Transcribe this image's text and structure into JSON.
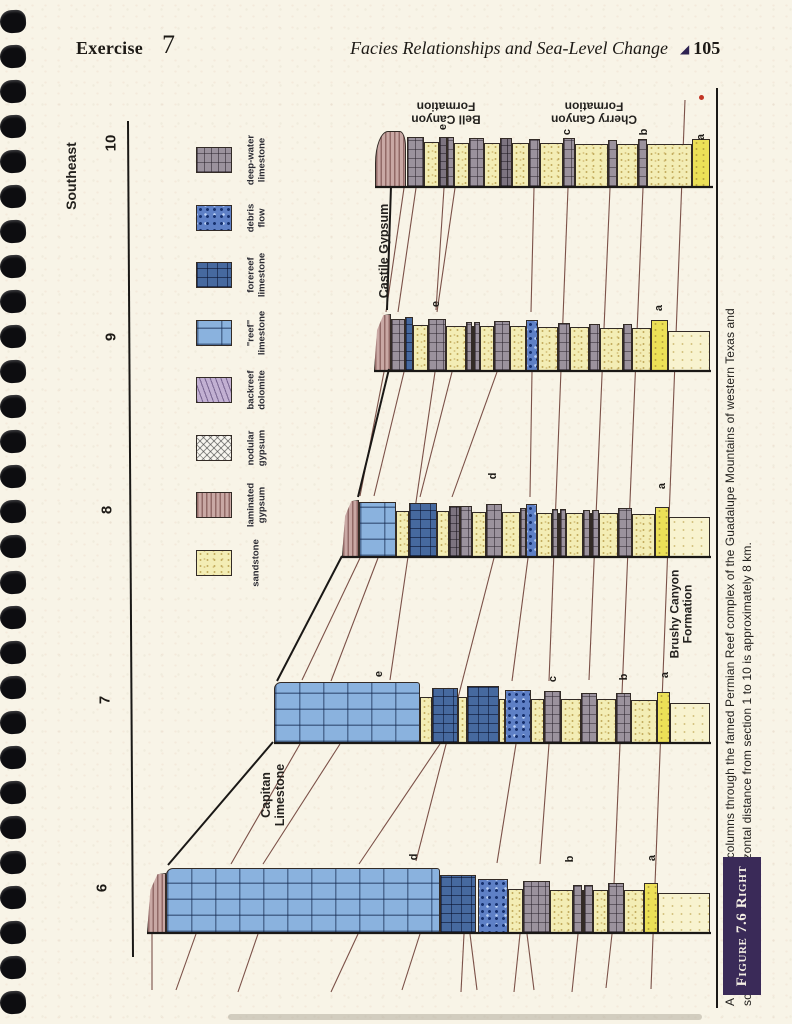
{
  "page": {
    "header": {
      "exercise_label": "Exercise",
      "exercise_number": "7",
      "running_title": "Facies Relationships and Sea-Level Change",
      "page_marker": "◢",
      "page_number": "105"
    }
  },
  "figure": {
    "colors": {
      "black_line": "#1a1816",
      "thin_line": "#7b5148",
      "figure_label_bg": "#3a2a58",
      "reef_blue": "#8ab2de",
      "forereef_blue": "#46699f",
      "debris_blue": "#5e80c6",
      "sandstone_yellow": "#f3edb5",
      "laminated_gypsum_pink": "#c9a8a4",
      "deepwater_gray": "#9b929d"
    },
    "direction_label": "Southeast",
    "section_numbers": [
      [
        "10",
        112,
        143
      ],
      [
        "9",
        112,
        337
      ],
      [
        "8",
        108,
        510
      ],
      [
        "7",
        106,
        700
      ],
      [
        "6",
        103,
        888
      ]
    ],
    "unit_labels": [
      {
        "text": "Southeast",
        "x": 72,
        "y": 176,
        "rot": -90,
        "size": 14
      },
      {
        "text": "Castile Gypsum",
        "x": 384,
        "y": 251,
        "rot": -90,
        "size": 12.5
      },
      {
        "text": "Capitan\nLimestone",
        "x": 273,
        "y": 795,
        "rot": -90,
        "size": 12.5
      },
      {
        "text": "Brushy Canyon\nFormation",
        "x": 682,
        "y": 614,
        "rot": -90,
        "size": 12
      },
      {
        "text": "Bell Canyon\nFormation",
        "x": 446,
        "y": 112,
        "rot": 180,
        "size": 12
      },
      {
        "text": "Cherry Canyon\nFormation",
        "x": 594,
        "y": 112,
        "rot": 180,
        "size": 12
      }
    ],
    "bed_labels": [
      [
        "e",
        443,
        127
      ],
      [
        "c",
        567,
        132
      ],
      [
        "b",
        644,
        132
      ],
      [
        "a",
        701,
        137
      ],
      [
        "e",
        436,
        304
      ],
      [
        "a",
        659,
        308
      ],
      [
        "d",
        493,
        476
      ],
      [
        "a",
        662,
        486
      ],
      [
        "e",
        379,
        674
      ],
      [
        "c",
        553,
        679
      ],
      [
        "b",
        624,
        677
      ],
      [
        "a",
        665,
        675
      ],
      [
        "d",
        414,
        857
      ],
      [
        "b",
        570,
        859
      ],
      [
        "a",
        652,
        858
      ]
    ],
    "legend": {
      "items": [
        {
          "label": "deep-water\nlimestone",
          "pattern": "gray",
          "y": 160
        },
        {
          "label": "debris\nflow",
          "pattern": "debris",
          "y": 218
        },
        {
          "label": "forereef\nlimestone",
          "pattern": "fore",
          "y": 275
        },
        {
          "label": "\"reef\"\nlimestone",
          "pattern": "reef",
          "y": 333
        },
        {
          "label": "backreef\ndolomite",
          "pattern": "dol",
          "y": 390
        },
        {
          "label": "nodular\ngypsum",
          "pattern": "nod",
          "y": 448
        },
        {
          "label": "laminated\ngypsum",
          "pattern": "lam",
          "y": 505
        },
        {
          "label": "sandstone",
          "pattern": "sand",
          "y": 563
        }
      ]
    },
    "sections": [
      {
        "number": "10",
        "x0": 375,
        "x1": 713,
        "base": 187,
        "blocks": [
          [
            "lam",
            375,
            406,
            56,
            "cap"
          ],
          [
            "gray",
            407,
            424,
            50
          ],
          [
            "sand",
            424,
            439,
            45
          ],
          [
            "grayD",
            439,
            447,
            50
          ],
          [
            "gray",
            447,
            454,
            50
          ],
          [
            "sand",
            454,
            469,
            44
          ],
          [
            "gray",
            469,
            484,
            49
          ],
          [
            "sand",
            484,
            500,
            44
          ],
          [
            "grayD",
            500,
            512,
            49
          ],
          [
            "sand",
            512,
            529,
            44
          ],
          [
            "gray",
            529,
            540,
            48
          ],
          [
            "sand",
            540,
            563,
            44
          ],
          [
            "gray",
            563,
            575,
            49
          ],
          [
            "sand",
            575,
            608,
            43
          ],
          [
            "gray",
            608,
            617,
            47
          ],
          [
            "sand",
            617,
            638,
            43
          ],
          [
            "gray",
            638,
            647,
            48
          ],
          [
            "sand",
            647,
            692,
            43
          ],
          [
            "sandA",
            692,
            710,
            48
          ]
        ]
      },
      {
        "number": "9",
        "x0": 374,
        "x1": 711,
        "base": 371,
        "blocks": [
          [
            "lam",
            374,
            391,
            57,
            "wedge"
          ],
          [
            "gray",
            391,
            405,
            52
          ],
          [
            "fore",
            405,
            413,
            54
          ],
          [
            "sand",
            413,
            428,
            46
          ],
          [
            "gray",
            428,
            446,
            52
          ],
          [
            "sand",
            446,
            466,
            45
          ],
          [
            "gray",
            466,
            472,
            49
          ],
          [
            "sand",
            472,
            474,
            45
          ],
          [
            "gray",
            474,
            480,
            49
          ],
          [
            "sand",
            480,
            494,
            45
          ],
          [
            "gray",
            494,
            510,
            50
          ],
          [
            "sand",
            510,
            526,
            45
          ],
          [
            "debris",
            526,
            538,
            51
          ],
          [
            "sand",
            538,
            558,
            44
          ],
          [
            "gray",
            558,
            570,
            48
          ],
          [
            "sand",
            570,
            589,
            44
          ],
          [
            "gray",
            589,
            600,
            47
          ],
          [
            "sand",
            600,
            623,
            43
          ],
          [
            "gray",
            623,
            632,
            47
          ],
          [
            "sand",
            632,
            651,
            43
          ],
          [
            "sandA",
            651,
            668,
            51
          ],
          [
            "sandP",
            668,
            710,
            40
          ]
        ]
      },
      {
        "number": "8",
        "x0": 342,
        "x1": 711,
        "base": 557,
        "blocks": [
          [
            "lam",
            342,
            359,
            57,
            "wedge"
          ],
          [
            "reef",
            359,
            396,
            55
          ],
          [
            "sand",
            396,
            409,
            46
          ],
          [
            "fore",
            409,
            437,
            54
          ],
          [
            "sand",
            437,
            449,
            46
          ],
          [
            "grayD",
            449,
            460,
            51
          ],
          [
            "gray",
            460,
            472,
            51
          ],
          [
            "sand",
            472,
            486,
            45
          ],
          [
            "gray",
            486,
            502,
            53
          ],
          [
            "sand",
            502,
            520,
            45
          ],
          [
            "gray",
            520,
            526,
            49
          ],
          [
            "debris",
            526,
            537,
            53
          ],
          [
            "sand",
            537,
            552,
            44
          ],
          [
            "gray",
            552,
            558,
            48
          ],
          [
            "sand",
            558,
            560,
            44
          ],
          [
            "gray",
            560,
            566,
            48
          ],
          [
            "sand",
            566,
            583,
            44
          ],
          [
            "gray",
            583,
            590,
            47
          ],
          [
            "sand",
            590,
            592,
            44
          ],
          [
            "gray",
            592,
            599,
            47
          ],
          [
            "sand",
            599,
            618,
            44
          ],
          [
            "gray",
            618,
            632,
            49
          ],
          [
            "sand",
            632,
            655,
            43
          ],
          [
            "sandA",
            655,
            669,
            50
          ],
          [
            "sandP",
            669,
            710,
            40
          ]
        ]
      },
      {
        "number": "7",
        "x0": 274,
        "x1": 711,
        "base": 743,
        "blocks": [
          [
            "reef",
            274,
            420,
            61,
            "reefcap"
          ],
          [
            "sand",
            420,
            432,
            46
          ],
          [
            "fore",
            432,
            458,
            55
          ],
          [
            "sand",
            458,
            467,
            46
          ],
          [
            "fore",
            467,
            499,
            57
          ],
          [
            "sand",
            499,
            505,
            44
          ],
          [
            "debris",
            505,
            531,
            53
          ],
          [
            "sand",
            531,
            544,
            44
          ],
          [
            "gray",
            544,
            561,
            52
          ],
          [
            "sand",
            561,
            581,
            44
          ],
          [
            "gray",
            581,
            597,
            50
          ],
          [
            "sand",
            597,
            616,
            44
          ],
          [
            "gray",
            616,
            631,
            50
          ],
          [
            "sand",
            631,
            657,
            43
          ],
          [
            "sandA",
            657,
            670,
            51
          ],
          [
            "sandP",
            670,
            710,
            40
          ]
        ]
      },
      {
        "number": "6",
        "x0": 147,
        "x1": 711,
        "base": 933,
        "blocks": [
          [
            "lam",
            147,
            166,
            60,
            "wedge"
          ],
          [
            "reef",
            166,
            440,
            65,
            "reefcap"
          ],
          [
            "fore",
            440,
            476,
            58
          ],
          [
            "debris",
            478,
            508,
            54
          ],
          [
            "sand",
            508,
            523,
            44
          ],
          [
            "gray",
            523,
            550,
            52
          ],
          [
            "sand",
            550,
            573,
            43
          ],
          [
            "gray",
            573,
            582,
            48
          ],
          [
            "sand",
            582,
            584,
            43
          ],
          [
            "gray",
            584,
            593,
            48
          ],
          [
            "sand",
            593,
            608,
            43
          ],
          [
            "gray",
            608,
            624,
            50
          ],
          [
            "sand",
            624,
            644,
            43
          ],
          [
            "sandA",
            644,
            658,
            50
          ],
          [
            "sandP",
            658,
            710,
            40
          ]
        ]
      }
    ],
    "lines": {
      "black": [
        [
          391,
          186,
          387,
          310
        ],
        [
          389,
          369,
          358,
          497
        ],
        [
          342,
          556,
          277,
          681
        ],
        [
          273,
          742,
          168,
          865
        ],
        [
          128,
          121,
          133,
          957
        ]
      ],
      "under": [
        [
          404,
          188,
          386,
          312
        ],
        [
          416,
          188,
          398,
          312
        ],
        [
          444,
          188,
          436,
          310
        ],
        [
          455,
          188,
          437,
          312
        ],
        [
          534,
          188,
          531,
          312
        ],
        [
          568,
          188,
          549,
          681
        ],
        [
          610,
          188,
          589,
          680
        ],
        [
          643,
          188,
          620,
          742
        ],
        [
          620,
          744,
          612,
          931
        ],
        [
          612,
          934,
          606,
          988
        ],
        [
          685,
          100,
          651,
          989
        ],
        [
          384,
          372,
          360,
          496
        ],
        [
          404,
          372,
          374,
          496
        ],
        [
          435,
          372,
          390,
          680
        ],
        [
          452,
          372,
          420,
          497
        ],
        [
          497,
          372,
          452,
          497
        ],
        [
          532,
          372,
          530,
          497
        ],
        [
          360,
          558,
          302,
          680
        ],
        [
          378,
          558,
          331,
          681
        ],
        [
          494,
          558,
          416,
          861
        ],
        [
          528,
          558,
          512,
          681
        ],
        [
          300,
          744,
          231,
          864
        ],
        [
          340,
          744,
          263,
          864
        ],
        [
          440,
          744,
          359,
          864
        ],
        [
          516,
          744,
          497,
          863
        ],
        [
          549,
          744,
          540,
          864
        ],
        [
          152,
          934,
          152,
          990
        ],
        [
          196,
          934,
          176,
          990
        ],
        [
          258,
          934,
          238,
          992
        ],
        [
          358,
          934,
          331,
          992
        ],
        [
          420,
          934,
          402,
          990
        ],
        [
          464,
          934,
          461,
          992
        ],
        [
          470,
          934,
          477,
          990
        ],
        [
          520,
          934,
          514,
          992
        ],
        [
          527,
          934,
          534,
          990
        ],
        [
          578,
          934,
          572,
          992
        ]
      ]
    },
    "red_mark": {
      "x": 699,
      "y": 95
    }
  },
  "caption": {
    "figure_label": "Figure 7.6 Right",
    "lines": [
      "A series of 10 stratigraphic columns through the famed Permian Reef complex of the Guadalupe Mountains of western Texas and",
      "southern New Mexico. Horizontal distance from section 1 to 10 is approximately 8 km."
    ]
  }
}
